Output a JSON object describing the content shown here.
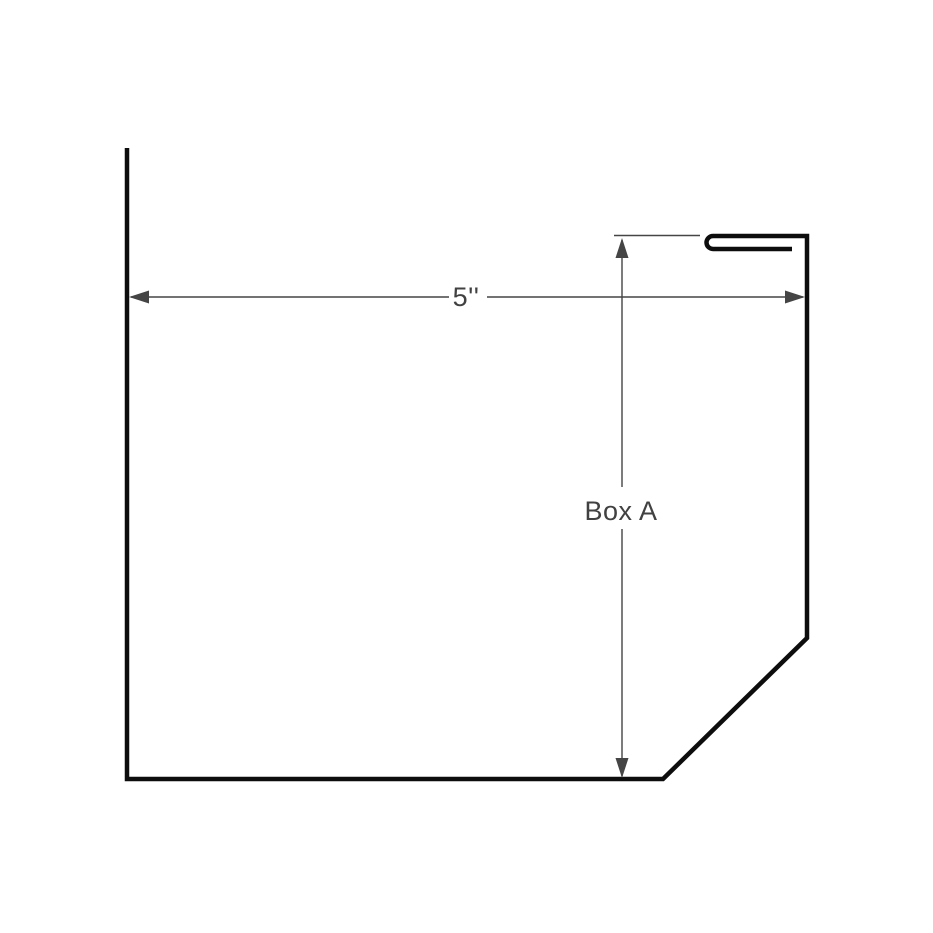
{
  "drawing": {
    "background_color": "#ffffff",
    "colors": {
      "shape": "#0d0d0d",
      "dimension": "#454545",
      "label": "#414141"
    },
    "dimensions": {
      "width": {
        "label": "5''"
      },
      "height": {
        "label": "Box A"
      }
    }
  }
}
